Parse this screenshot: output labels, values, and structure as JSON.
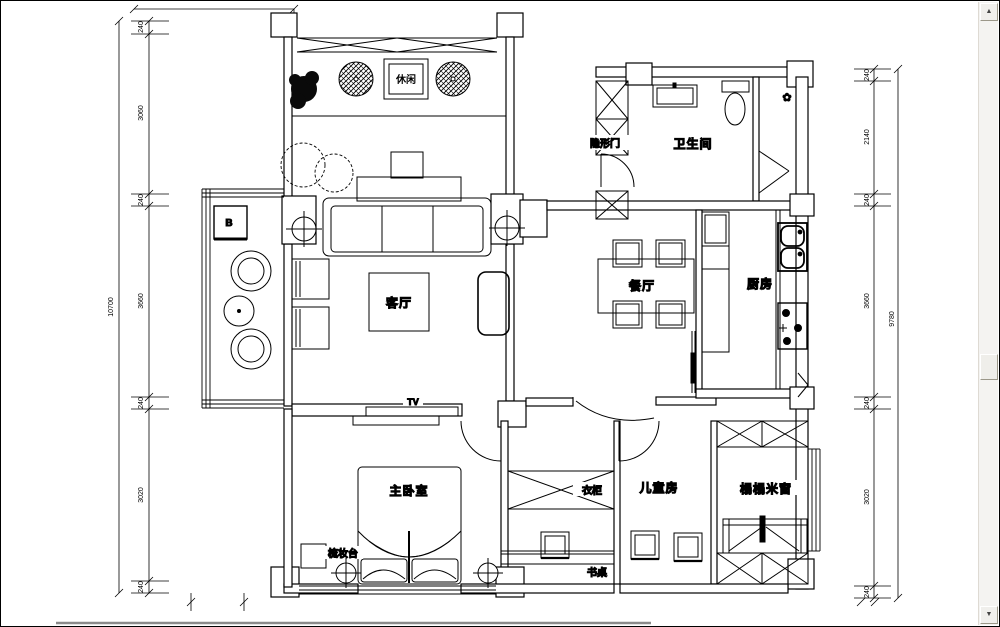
{
  "floor_plan": {
    "rooms": {
      "leisure": "休闲",
      "hidden_door": "隐形门",
      "bathroom": "卫生间",
      "dining": "餐厅",
      "kitchen": "厨房",
      "living": "客厅",
      "tv_label": "TV",
      "master_bedroom": "主卧室",
      "dressing_table": "梳妆台",
      "wardrobe": "衣柜",
      "desk": "书桌",
      "children_room": "儿童房",
      "tatami_room": "榻榻米窗",
      "cabinet_label": "B"
    },
    "icons": {
      "fan_flower": "✿"
    },
    "dimensions": {
      "left_total": "10700",
      "left_chain": [
        "240",
        "3060",
        "240",
        "3660",
        "240",
        "3020",
        "240"
      ],
      "right_total": "9780",
      "right_chain": [
        "240",
        "2140",
        "240",
        "3660",
        "240",
        "3020",
        "240"
      ]
    },
    "colors": {
      "line": "#000000",
      "bottom_rule": "#8a8a8a"
    }
  },
  "window": {
    "scrollbar": {
      "up_glyph": "▲",
      "down_glyph": "▼"
    }
  }
}
